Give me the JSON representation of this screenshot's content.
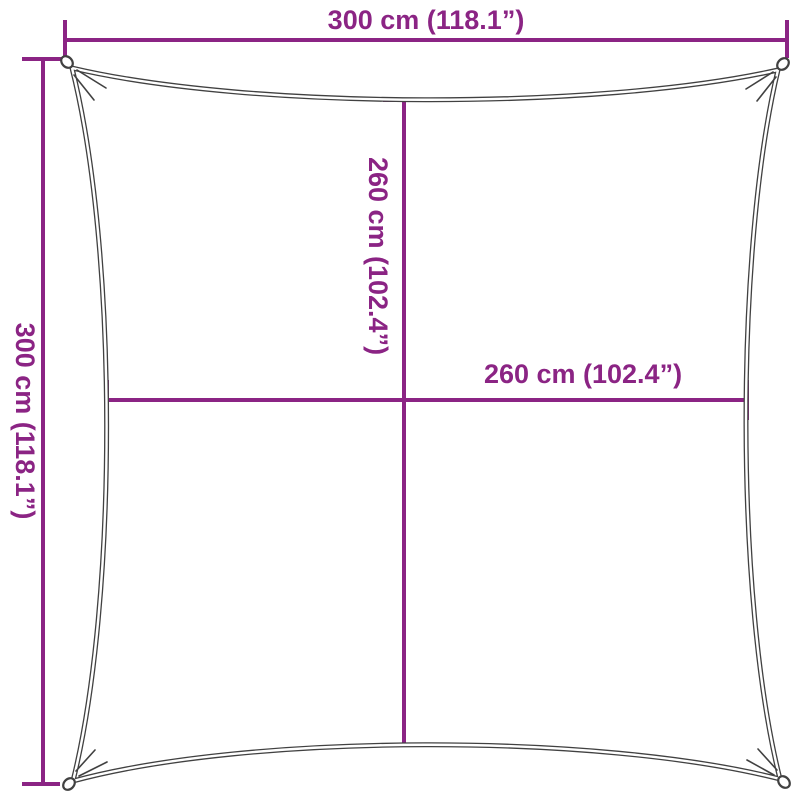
{
  "diagram_kind": "shade-sail-dimension-diagram",
  "colors": {
    "dimension": "#8B2484",
    "outline": "#414141",
    "background": "#FFFFFF"
  },
  "labels": {
    "top_width": "300 cm (118.1”)",
    "left_height": "300 cm (118.1”)",
    "inner_height": "260 cm (102.4”)",
    "inner_width": "260 cm (102.4”)"
  }
}
